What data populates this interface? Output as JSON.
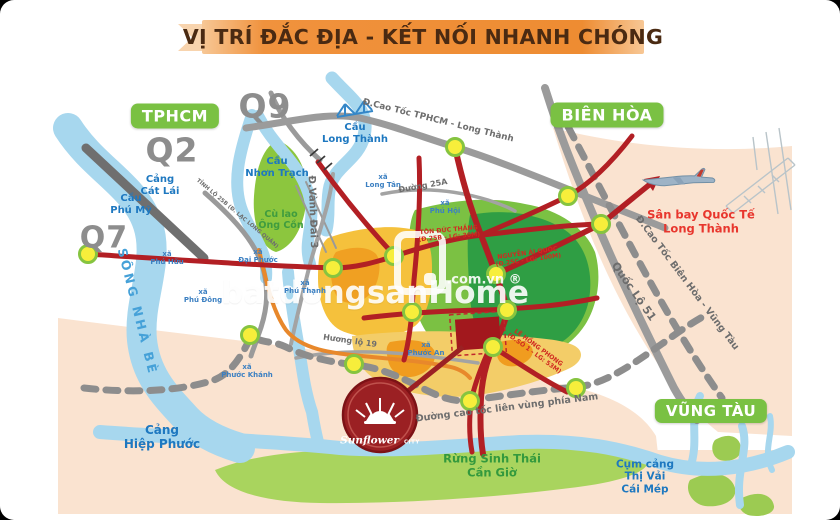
{
  "title": {
    "text": "VỊ TRÍ ĐẮC ĐỊA - KẾT NỐI NHANH CHÓNG"
  },
  "watermark": {
    "text": "batdongsanHome",
    "domain": ".com.vn ®"
  },
  "logo": {
    "name": "Sunflower",
    "suffix": "CITY"
  },
  "colors": {
    "badge_green": "#7ac143",
    "road_red": "#b21f24",
    "water_blue": "#a7d7ee",
    "zone_yellow": "#f5c13c",
    "zone_dark_green": "#2f9e44",
    "zone_light_green": "#7bc143",
    "land_peach": "#fae3d0",
    "ribbon_orange": "#ee8c32",
    "logo_maroon": "#9b2023",
    "node_yellow": "#f7ee3b",
    "highway_gray": "#9b9b9b"
  },
  "badges": [
    {
      "id": "tphcm",
      "text": "TPHCM"
    },
    {
      "id": "bien-hoa",
      "text": "BIÊN HÒA"
    },
    {
      "id": "vung-tau",
      "text": "VŨNG TÀU"
    }
  ],
  "districts": [
    {
      "id": "q9",
      "text": "Q9"
    },
    {
      "id": "q2",
      "text": "Q2"
    },
    {
      "id": "q7",
      "text": "Q7"
    }
  ],
  "places": [
    {
      "id": "cau-long-thanh",
      "text": "Cầu\nLong Thành"
    },
    {
      "id": "cau-nhon-trach",
      "text": "Cầu\nNhơn Trạch"
    },
    {
      "id": "cang-cat-lai",
      "text": "Cảng\nCát Lái"
    },
    {
      "id": "cau-phu-my",
      "text": "Cầu\nPhú Mỹ"
    },
    {
      "id": "cang-hiep-phuoc",
      "text": "Cảng\nHiệp Phước"
    },
    {
      "id": "cum-cang-thi-vai-cai-mep",
      "text": "Cụm cảng\nThị Vải\nCái Mép"
    },
    {
      "id": "song-nha-be",
      "text": "SÔNG NHÀ BÈ"
    },
    {
      "id": "cu-lao-ong-con",
      "text": "Cù lao\nÔng Cồn"
    },
    {
      "id": "rung-sinh-thai-can-gio",
      "text": "Rừng Sinh Thái\nCần Giờ"
    },
    {
      "id": "san-bay-long-thanh",
      "text": "Sân bay Quốc Tế\nLong Thành"
    }
  ],
  "communes": [
    {
      "id": "xa-long-tan",
      "text": "xã\nLong Tân"
    },
    {
      "id": "xa-phu-hoi",
      "text": "xã\nPhú Hội"
    },
    {
      "id": "xa-phu-huu",
      "text": "xã\nPhú Hữu"
    },
    {
      "id": "xa-phu-dong",
      "text": "xã\nPhú Đông"
    },
    {
      "id": "xa-dai-phuoc",
      "text": "xã\nĐại Phước"
    },
    {
      "id": "xa-phu-thanh",
      "text": "xã\nPhú Thạnh"
    },
    {
      "id": "xa-phuoc-khanh",
      "text": "xã\nPhước Khánh"
    },
    {
      "id": "xa-phuoc-an",
      "text": "xã\nPhước An"
    }
  ],
  "roads": [
    {
      "id": "cao-toc-tphcm-long-thanh",
      "text": "Đ.Cao Tốc TPHCM - Long Thành"
    },
    {
      "id": "quoc-lo-51",
      "text": "Quốc Lộ 51"
    },
    {
      "id": "cao-toc-bien-hoa-vung-tau",
      "text": "Đ.Cao Tốc Biên Hòa - Vũng Tàu"
    },
    {
      "id": "vanh-dai-3",
      "text": "Đ.Vành Đai 3"
    },
    {
      "id": "tinh-lo-25b",
      "text": "TỈNH LỘ 25B (Đ. LẠC LONG QUÂN)"
    },
    {
      "id": "duong-25a",
      "text": "Đường 25A"
    },
    {
      "id": "huong-lo-19",
      "text": "Hương lộ 19"
    },
    {
      "id": "cao-toc-lien-vung",
      "text": "Đường cao tốc liên vùng phía Nam"
    }
  ],
  "red_roads": [
    {
      "id": "ton-duc-thang",
      "text": "TÔN ĐỨC THẮNG\n(Đ.25B - LG: 30M)"
    },
    {
      "id": "nguyen-ai-quoc",
      "text": "NGUYỄN ÁI QUỐC\n(Đ.25C - LG: 100M)"
    },
    {
      "id": "le-hong-phong",
      "text": "LÊ HỒNG PHONG\n(Đ.SỐ 1 - LG: 53M)"
    }
  ]
}
